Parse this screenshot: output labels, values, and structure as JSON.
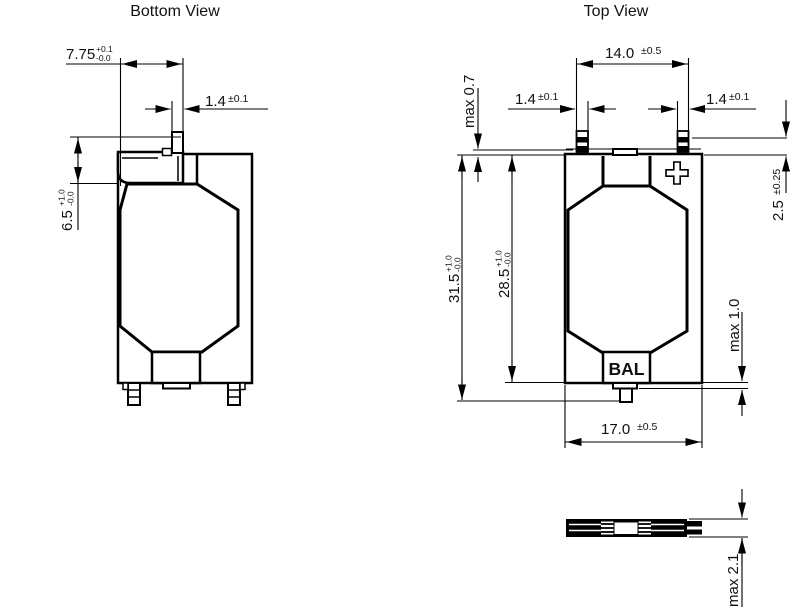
{
  "titles": {
    "bottom_view": "Bottom View",
    "top_view": "Top View"
  },
  "bottom_view": {
    "dims": {
      "tab_width": {
        "value": "7.75",
        "tol_plus": "+0.1",
        "tol_minus": "-0.0"
      },
      "pin_width": {
        "value": "1.4",
        "tol": "±0.1"
      },
      "tab_height": {
        "value": "6.5",
        "tol_plus": "+1.0",
        "tol_minus": "-0.0"
      }
    }
  },
  "top_view": {
    "labels": {
      "polarity": "+",
      "balance": "BAL"
    },
    "dims": {
      "pin_pitch": {
        "value": "14.0",
        "tol": "±0.5"
      },
      "pin_left_width": {
        "value": "1.4",
        "tol": "±0.1"
      },
      "pin_right_width": {
        "value": "1.4",
        "tol": "±0.1"
      },
      "seal_protrusion": {
        "value": "max 0.7"
      },
      "terminal_length": {
        "value": "2.5",
        "tol": "±0.25"
      },
      "total_height": {
        "value": "31.5",
        "tol_plus": "+1.0",
        "tol_minus": "-0.0"
      },
      "body_height": {
        "value": "28.5",
        "tol_plus": "+1.0",
        "tol_minus": "-0.0"
      },
      "bal_tab_protrusion": {
        "value": "max 1.0"
      },
      "body_width": {
        "value": "17.0",
        "tol": "±0.5"
      }
    }
  },
  "side_view": {
    "dims": {
      "thickness": {
        "value": "max 2.1"
      }
    }
  }
}
